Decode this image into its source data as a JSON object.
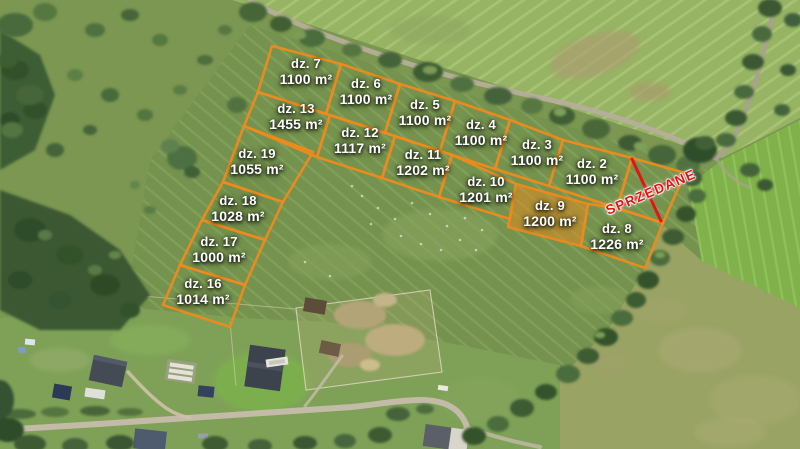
{
  "image_kind": "aerial-photo-plot-map",
  "colors": {
    "plot_line": "#EE8A1C",
    "plot_fill": "rgba(238,138,28,0.5)",
    "sold_red": "#E31414",
    "label_text": "#FFFFFF"
  },
  "overlay": {
    "plots": [
      {
        "name": "dz. 7",
        "area": "1100 m²",
        "cx": 306,
        "cy": 72,
        "points": "272,46 341,64 326,114 258,92"
      },
      {
        "name": "dz. 6",
        "area": "1100 m²",
        "cx": 366,
        "cy": 92,
        "points": "341,64 400,84 385,133 326,114"
      },
      {
        "name": "dz. 5",
        "area": "1100 m²",
        "cx": 425,
        "cy": 113,
        "points": "400,84 455,101 440,151 385,133"
      },
      {
        "name": "dz. 4",
        "area": "1100 m²",
        "cx": 481,
        "cy": 133,
        "points": "455,101 510,120 495,169 440,151"
      },
      {
        "name": "dz. 3",
        "area": "1100 m²",
        "cx": 537,
        "cy": 153,
        "points": "510,120 563,140 549,186 495,169"
      },
      {
        "name": "dz. 2",
        "area": "1100 m²",
        "cx": 592,
        "cy": 172,
        "points": "563,140 632,158 617,208 549,186"
      },
      {
        "name": "dz. 13",
        "area": "1455 m²",
        "cx": 296,
        "cy": 117,
        "points": "258,92 330,115 317,157 244,126"
      },
      {
        "name": "dz. 12",
        "area": "1117 m²",
        "cx": 360,
        "cy": 141,
        "points": "330,115 395,136 382,178 317,157"
      },
      {
        "name": "dz. 11",
        "area": "1202 m²",
        "cx": 423,
        "cy": 163,
        "points": "395,136 452,155 439,197 382,178"
      },
      {
        "name": "dz. 10",
        "area": "1201 m²",
        "cx": 486,
        "cy": 190,
        "points": "452,155 516,184 510,219 439,197"
      },
      {
        "name": "dz. 9",
        "area": "1200 m²",
        "cx": 550,
        "cy": 214,
        "points": "516,184 588,204 581,246 508,227",
        "highlighted": true
      },
      {
        "name": "dz. 8",
        "area": "1226 m²",
        "cx": 617,
        "cy": 237,
        "points": "588,204 617,208 663,223 645,268 581,246"
      },
      {
        "name": "dz. 19",
        "area": "1055 m²",
        "cx": 257,
        "cy": 162,
        "points": "244,126 313,152 283,202 223,182"
      },
      {
        "name": "dz. 18",
        "area": "1028 m²",
        "cx": 238,
        "cy": 209,
        "points": "223,182 283,202 265,240 202,220"
      },
      {
        "name": "dz. 17",
        "area": "1000 m²",
        "cx": 219,
        "cy": 250,
        "points": "202,220 265,240 245,285 180,265"
      },
      {
        "name": "dz. 16",
        "area": "1014 m²",
        "cx": 203,
        "cy": 292,
        "points": "180,265 245,285 230,327 163,305"
      }
    ],
    "sold": {
      "label": "SPRZEDANE",
      "points": "632,158 685,173 663,223 617,208",
      "cross": "632,159 661,221;618,207 683,175",
      "label_x": 651,
      "label_y": 192,
      "label_rotation": -23
    }
  }
}
